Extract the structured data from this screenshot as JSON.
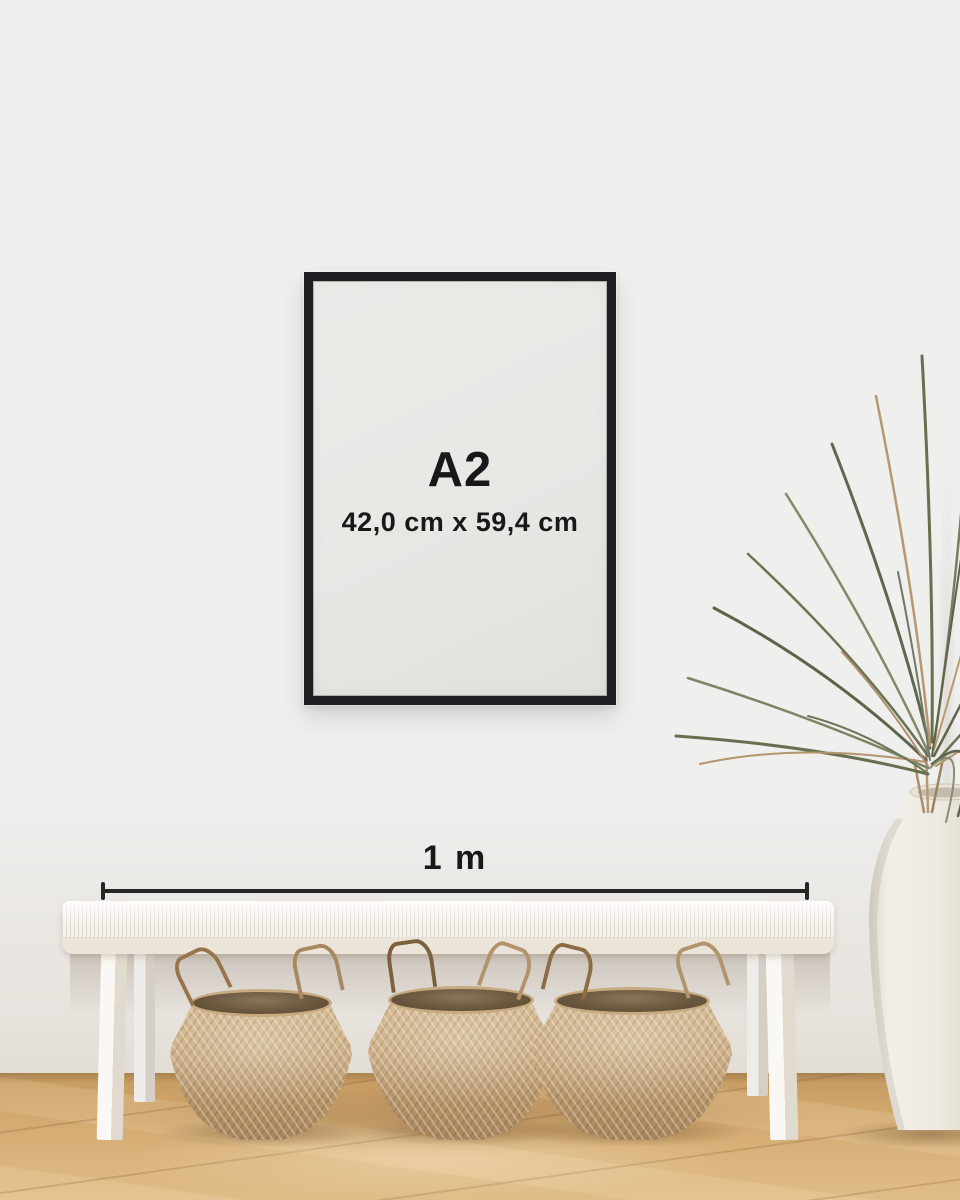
{
  "poster": {
    "size_label": "A2",
    "dimensions_label": "42,0 cm x 59,4 cm"
  },
  "scale_bar": {
    "label": "1 m"
  },
  "objects": {
    "frame": "black-poster-frame",
    "bench": "white-woven-bench",
    "baskets": [
      "seagrass-belly-basket",
      "seagrass-belly-basket",
      "seagrass-belly-basket"
    ],
    "vase": "white-ceramic-floor-vase",
    "plant": "dried-palm-plant",
    "floor": "oak-wood-floor"
  },
  "colors": {
    "wall": "#efefee",
    "frame": "#1d1f22",
    "poster": "#e9e7e4",
    "text": "#17181a",
    "scale_line": "#262626",
    "bench": "#f6f3ee",
    "bench_apron": "#ebe4d9",
    "basket_light": "#d3b68e",
    "basket_mid": "#c6a77c",
    "basket_dark": "#a8845c",
    "basket_rim": "#57462f",
    "floor_light": "#e0bd88",
    "floor_mid": "#d4ab72",
    "floor_dark": "#c59a60",
    "vase": "#eeebe4",
    "plant_green": "#67704f",
    "plant_green_light": "#828868",
    "plant_tan": "#b5946b"
  }
}
